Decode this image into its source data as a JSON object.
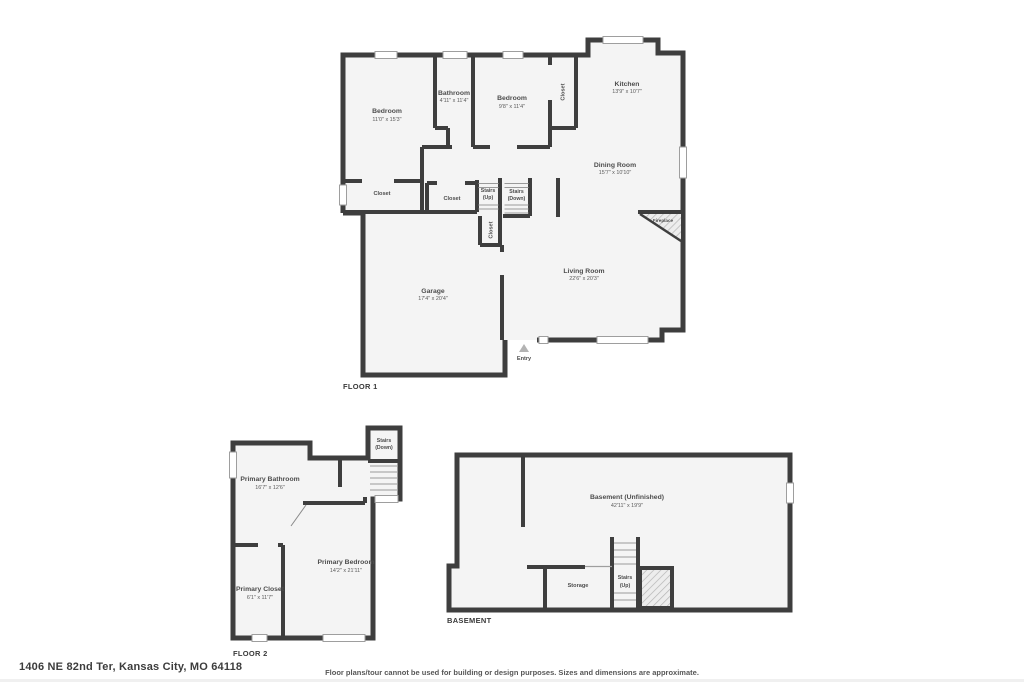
{
  "page": {
    "address": "1406 NE 82nd Ter, Kansas City, MO 64118",
    "disclaimer": "Floor plans/tour cannot be used for building or design purposes. Sizes and dimensions are approximate."
  },
  "colors": {
    "wall": "#3e3e3e",
    "room_fill": "#f4f4f4",
    "label_text": "#4d4d4d",
    "caption_text": "#3a3a3a",
    "window_line": "#9e9e9e",
    "entry_marker": "#b3b3b3",
    "hatch_line": "#b5b5b5"
  },
  "floor1": {
    "caption": "FLOOR 1",
    "rooms": {
      "bedroom1": {
        "name": "Bedroom",
        "dims": "11'0\" x 15'3\""
      },
      "bathroom": {
        "name": "Bathroom",
        "dims": "4'11\" x 11'4\""
      },
      "bedroom2": {
        "name": "Bedroom",
        "dims": "9'8\" x 11'4\""
      },
      "kitchen": {
        "name": "Kitchen",
        "dims": "13'9\" x 10'7\""
      },
      "dining_room": {
        "name": "Dining Room",
        "dims": "15'7\" x 10'10\""
      },
      "living_room": {
        "name": "Living Room",
        "dims": "22'6\" x 20'3\""
      },
      "garage": {
        "name": "Garage",
        "dims": "17'4\" x 20'4\""
      }
    },
    "features": {
      "closet_bedroom1": "Closet",
      "closet_hall": "Closet",
      "closet_bedroom2": "Closet",
      "closet_entry": "Closet",
      "stairs_up_line1": "Stairs",
      "stairs_up_line2": "(Up)",
      "stairs_down_line1": "Stairs",
      "stairs_down_line2": "(Down)",
      "fireplace": "Fireplace",
      "entry": "Entry"
    }
  },
  "floor2": {
    "caption": "FLOOR 2",
    "rooms": {
      "primary_bathroom": {
        "name": "Primary Bathroom",
        "dims": "16'7\" x 12'6\""
      },
      "primary_bedroom": {
        "name": "Primary Bedroom",
        "dims": "14'2\" x 21'11\""
      },
      "primary_closet": {
        "name": "Primary Closet",
        "dims": "6'1\" x 11'7\""
      }
    },
    "features": {
      "stairs_down_line1": "Stairs",
      "stairs_down_line2": "(Down)"
    }
  },
  "basement": {
    "caption": "BASEMENT",
    "rooms": {
      "basement_main": {
        "name": "Basement (Unfinished)",
        "dims": "42'11\" x 19'9\""
      },
      "storage": {
        "name": "Storage"
      }
    },
    "features": {
      "stairs_up_line1": "Stairs",
      "stairs_up_line2": "(Up)"
    }
  }
}
